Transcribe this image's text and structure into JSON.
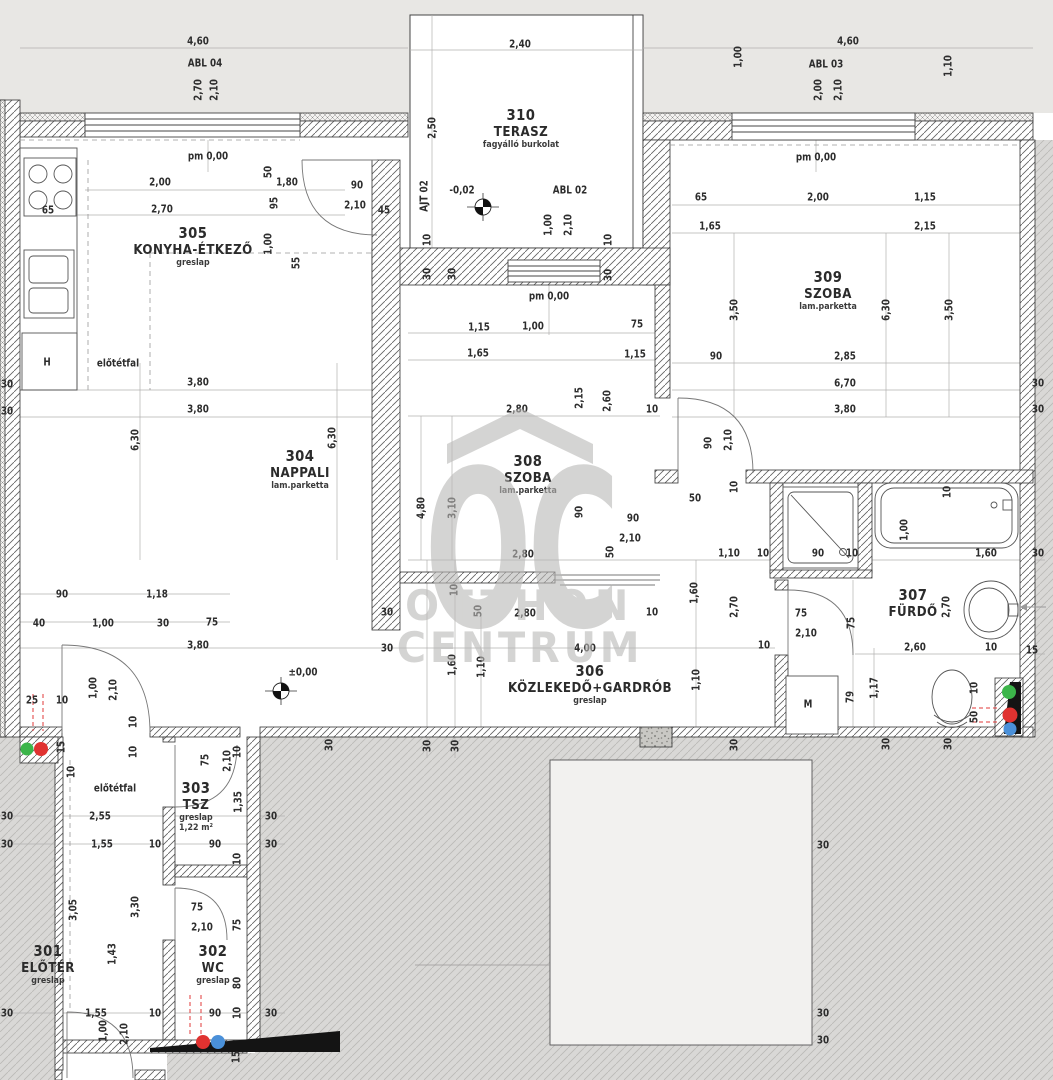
{
  "watermark": {
    "letters": "OC",
    "line1": "OTTHON",
    "line2": "CENTRUM",
    "color": "#b9b8b6"
  },
  "riser_colors": {
    "green": "#3cb54a",
    "red": "#e03230",
    "blue": "#4a90d9"
  },
  "rooms": [
    {
      "number": "310",
      "name": "TERASZ",
      "material": "fagyálló burkolat",
      "x": 521,
      "y": 128
    },
    {
      "number": "305",
      "name": "KONYHA-ÉTKEZŐ",
      "material": "greslap",
      "x": 193,
      "y": 246
    },
    {
      "number": "309",
      "name": "SZOBA",
      "material": "lam.parketta",
      "x": 828,
      "y": 290
    },
    {
      "number": "304",
      "name": "NAPPALI",
      "material": "lam.parketta",
      "x": 300,
      "y": 469
    },
    {
      "number": "308",
      "name": "SZOBA",
      "material": "lam.parketta",
      "x": 528,
      "y": 474
    },
    {
      "number": "306",
      "name": "KÖZLEKEDŐ+GARDRÓB",
      "material": "greslap",
      "x": 590,
      "y": 684
    },
    {
      "number": "307",
      "name": "FÜRDŐ",
      "material": "",
      "x": 913,
      "y": 603
    },
    {
      "number": "303",
      "name": "TSZ",
      "material": "greslap",
      "extra": "1,22 m²",
      "x": 196,
      "y": 806
    },
    {
      "number": "302",
      "name": "WC",
      "material": "greslap",
      "x": 213,
      "y": 964
    },
    {
      "number": "301",
      "name": "ELŐTÉR",
      "material": "greslap",
      "x": 48,
      "y": 964
    }
  ],
  "labels": [
    [
      "4,60",
      198,
      41
    ],
    [
      "ABL 04",
      205,
      63
    ],
    [
      "2,70",
      198,
      90,
      1
    ],
    [
      "2,10",
      214,
      90,
      1
    ],
    [
      "2,40",
      520,
      44
    ],
    [
      "2,50",
      432,
      128,
      1
    ],
    [
      "4,60",
      848,
      41
    ],
    [
      "ABL 03",
      826,
      64
    ],
    [
      "2,00",
      818,
      90,
      1
    ],
    [
      "2,10",
      838,
      90,
      1
    ],
    [
      "1,00",
      738,
      57,
      1
    ],
    [
      "1,10",
      948,
      66,
      1
    ],
    [
      "AJT 02",
      424,
      196,
      1
    ],
    [
      "-0,02",
      462,
      190
    ],
    [
      "ABL 02",
      570,
      190
    ],
    [
      "1,00",
      548,
      225,
      1
    ],
    [
      "2,10",
      568,
      225,
      1
    ],
    [
      "90",
      357,
      185
    ],
    [
      "2,10",
      355,
      205
    ],
    [
      "45",
      384,
      210
    ],
    [
      "10",
      427,
      240,
      1
    ],
    [
      "30",
      427,
      274,
      1
    ],
    [
      "30",
      452,
      274,
      1
    ],
    [
      "10",
      608,
      240,
      1
    ],
    [
      "30",
      608,
      275,
      1
    ],
    [
      "pm 0,00",
      549,
      296
    ],
    [
      "pm 0,00",
      208,
      156
    ],
    [
      "pm 0,00",
      816,
      157
    ],
    [
      "2,00",
      160,
      182
    ],
    [
      "50",
      268,
      172,
      1
    ],
    [
      "1,80",
      287,
      182
    ],
    [
      "95",
      274,
      203,
      1
    ],
    [
      "2,70",
      162,
      209
    ],
    [
      "65",
      48,
      210
    ],
    [
      "1,00",
      268,
      244,
      1
    ],
    [
      "55",
      296,
      263,
      1
    ],
    [
      "előtétfal",
      118,
      363
    ],
    [
      "H",
      47,
      362
    ],
    [
      "3,80",
      198,
      382
    ],
    [
      "3,80",
      198,
      409
    ],
    [
      "30",
      7,
      384
    ],
    [
      "30",
      7,
      411
    ],
    [
      "6,30",
      135,
      440,
      1
    ],
    [
      "6,30",
      332,
      438,
      1
    ],
    [
      "65",
      701,
      197
    ],
    [
      "2,00",
      818,
      197
    ],
    [
      "1,15",
      925,
      197
    ],
    [
      "1,65",
      710,
      226
    ],
    [
      "2,15",
      925,
      226
    ],
    [
      "6,30",
      886,
      310,
      1
    ],
    [
      "3,50",
      734,
      310,
      1
    ],
    [
      "3,50",
      949,
      310,
      1
    ],
    [
      "90",
      716,
      356
    ],
    [
      "2,85",
      845,
      356
    ],
    [
      "6,70",
      845,
      383
    ],
    [
      "3,80",
      845,
      409
    ],
    [
      "30",
      1038,
      383
    ],
    [
      "30",
      1038,
      409
    ],
    [
      "90",
      708,
      443,
      1
    ],
    [
      "2,10",
      728,
      440,
      1
    ],
    [
      "10",
      734,
      487,
      1
    ],
    [
      "50",
      695,
      498
    ],
    [
      "1,15",
      479,
      327
    ],
    [
      "1,00",
      533,
      326
    ],
    [
      "75",
      637,
      324
    ],
    [
      "1,65",
      478,
      353
    ],
    [
      "1,15",
      635,
      354
    ],
    [
      "2,80",
      517,
      409
    ],
    [
      "2,15",
      579,
      398,
      1
    ],
    [
      "2,60",
      607,
      401,
      1
    ],
    [
      "10",
      652,
      409
    ],
    [
      "4,80",
      421,
      508,
      1
    ],
    [
      "3,10",
      452,
      508,
      1
    ],
    [
      "90",
      579,
      512,
      1
    ],
    [
      "2,80",
      523,
      554
    ],
    [
      "90",
      633,
      518
    ],
    [
      "2,10",
      630,
      538
    ],
    [
      "50",
      610,
      552,
      1
    ],
    [
      "10",
      763,
      553
    ],
    [
      "1,10",
      729,
      553
    ],
    [
      "90",
      818,
      553
    ],
    [
      "10",
      852,
      553
    ],
    [
      "10",
      454,
      590,
      1
    ],
    [
      "50",
      478,
      611,
      1
    ],
    [
      "2,80",
      525,
      613
    ],
    [
      "4,00",
      585,
      648
    ],
    [
      "1,60",
      694,
      593,
      1
    ],
    [
      "2,70",
      734,
      607,
      1
    ],
    [
      "1,10",
      696,
      680,
      1
    ],
    [
      "10",
      652,
      612
    ],
    [
      "75",
      801,
      613
    ],
    [
      "2,10",
      806,
      633
    ],
    [
      "10",
      764,
      645
    ],
    [
      "M",
      808,
      704
    ],
    [
      "79",
      850,
      697,
      1
    ],
    [
      "75",
      851,
      623,
      1
    ],
    [
      "30",
      734,
      745,
      1
    ],
    [
      "1,60",
      452,
      665,
      1
    ],
    [
      "1,10",
      481,
      667,
      1
    ],
    [
      "30",
      387,
      612
    ],
    [
      "30",
      387,
      648
    ],
    [
      "1,00",
      904,
      530,
      1
    ],
    [
      "10",
      947,
      492,
      1
    ],
    [
      "1,60",
      986,
      553
    ],
    [
      "30",
      1038,
      553
    ],
    [
      "2,60",
      915,
      647
    ],
    [
      "10",
      991,
      647
    ],
    [
      "15",
      1032,
      650
    ],
    [
      "2,70",
      946,
      607,
      1
    ],
    [
      "1,17",
      874,
      688,
      1
    ],
    [
      "10",
      974,
      688,
      1
    ],
    [
      "50",
      974,
      717,
      1
    ],
    [
      "30",
      886,
      744,
      1
    ],
    [
      "30",
      948,
      744,
      1
    ],
    [
      "90",
      62,
      594
    ],
    [
      "1,18",
      157,
      594
    ],
    [
      "40",
      39,
      623
    ],
    [
      "1,00",
      103,
      623
    ],
    [
      "30",
      163,
      623
    ],
    [
      "75",
      212,
      622
    ],
    [
      "3,80",
      198,
      645
    ],
    [
      "±0,00",
      303,
      672
    ],
    [
      "25",
      32,
      700
    ],
    [
      "10",
      62,
      700
    ],
    [
      "1,00",
      93,
      688,
      1
    ],
    [
      "2,10",
      113,
      690,
      1
    ],
    [
      "15",
      61,
      747,
      1
    ],
    [
      "10",
      71,
      772,
      1
    ],
    [
      "10",
      133,
      722,
      1
    ],
    [
      "10",
      133,
      752,
      1
    ],
    [
      "előtétfal",
      115,
      788
    ],
    [
      "30",
      7,
      816
    ],
    [
      "30",
      7,
      844
    ],
    [
      "2,55",
      100,
      816
    ],
    [
      "1,55",
      102,
      844
    ],
    [
      "10",
      155,
      844
    ],
    [
      "3,05",
      73,
      910,
      1
    ],
    [
      "3,30",
      135,
      907,
      1
    ],
    [
      "1,43",
      112,
      954,
      1
    ],
    [
      "75",
      205,
      760,
      1
    ],
    [
      "2,10",
      227,
      761,
      1
    ],
    [
      "10",
      237,
      752,
      1
    ],
    [
      "1,35",
      238,
      802,
      1
    ],
    [
      "90",
      215,
      844
    ],
    [
      "30",
      271,
      816
    ],
    [
      "30",
      271,
      844
    ],
    [
      "10",
      237,
      859,
      1
    ],
    [
      "75",
      197,
      907
    ],
    [
      "2,10",
      202,
      927
    ],
    [
      "75",
      237,
      925,
      1
    ],
    [
      "80",
      237,
      983,
      1
    ],
    [
      "90",
      215,
      1013
    ],
    [
      "10",
      237,
      1013,
      1
    ],
    [
      "30",
      271,
      1013
    ],
    [
      "1,55",
      96,
      1013
    ],
    [
      "10",
      155,
      1013
    ],
    [
      "30",
      7,
      1013
    ],
    [
      "1,00",
      103,
      1031,
      1
    ],
    [
      "2,10",
      124,
      1034,
      1
    ],
    [
      "15",
      236,
      1057,
      1
    ],
    [
      "30",
      329,
      745,
      1
    ],
    [
      "30",
      427,
      746,
      1
    ],
    [
      "30",
      455,
      746,
      1
    ],
    [
      "30",
      823,
      845
    ],
    [
      "30",
      823,
      1013
    ],
    [
      "30",
      823,
      1040
    ]
  ]
}
